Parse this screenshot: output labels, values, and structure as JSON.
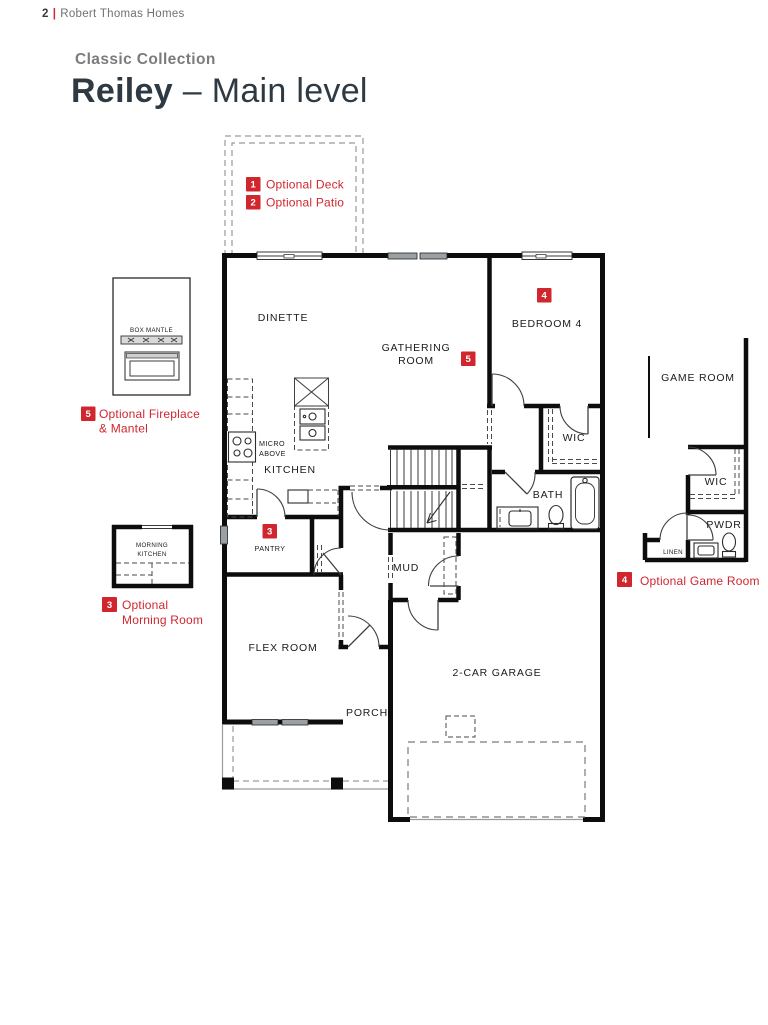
{
  "colors": {
    "accent_red": "#D0262E",
    "dark_text": "#2E3A43",
    "gray_text": "#797B7E",
    "wall_black": "#0D0D0D",
    "window_gray": "#9AA0A3"
  },
  "header": {
    "page_number": "2",
    "divider": "|",
    "brand": "Robert Thomas Homes",
    "collection": "Classic Collection",
    "plan_name": "Reiley",
    "dash": "–",
    "level": "Main level"
  },
  "legend": {
    "deck": {
      "num": "1",
      "label": "Optional Deck"
    },
    "patio": {
      "num": "2",
      "label": "Optional Patio"
    },
    "morning": {
      "num": "3",
      "line1": "Optional",
      "line2": "Morning Room"
    },
    "game": {
      "num": "4",
      "label": "Optional Game Room"
    },
    "fireplace": {
      "num": "5",
      "line1": "Optional Fireplace",
      "line2": "& Mantel"
    }
  },
  "plan_badges": {
    "pantry": "3",
    "bedroom": "4",
    "gathering": "5"
  },
  "rooms": {
    "dinette": "DINETTE",
    "gathering_line1": "GATHERING",
    "gathering_line2": "ROOM",
    "bedroom4": "BEDROOM 4",
    "wic": "WIC",
    "bath": "BATH",
    "kitchen": "KITCHEN",
    "micro_line1": "MICRO",
    "micro_line2": "ABOVE",
    "pantry": "PANTRY",
    "mud": "MUD",
    "flex": "FLEX ROOM",
    "porch": "PORCH",
    "garage": "2-CAR GARAGE",
    "game_room": "GAME ROOM",
    "wic_inset": "WIC",
    "pwdr": "PWDR",
    "linen": "LINEN",
    "morning_line1": "MORNING",
    "morning_line2": "KITCHEN",
    "box_mantle": "BOX MANTLE"
  }
}
